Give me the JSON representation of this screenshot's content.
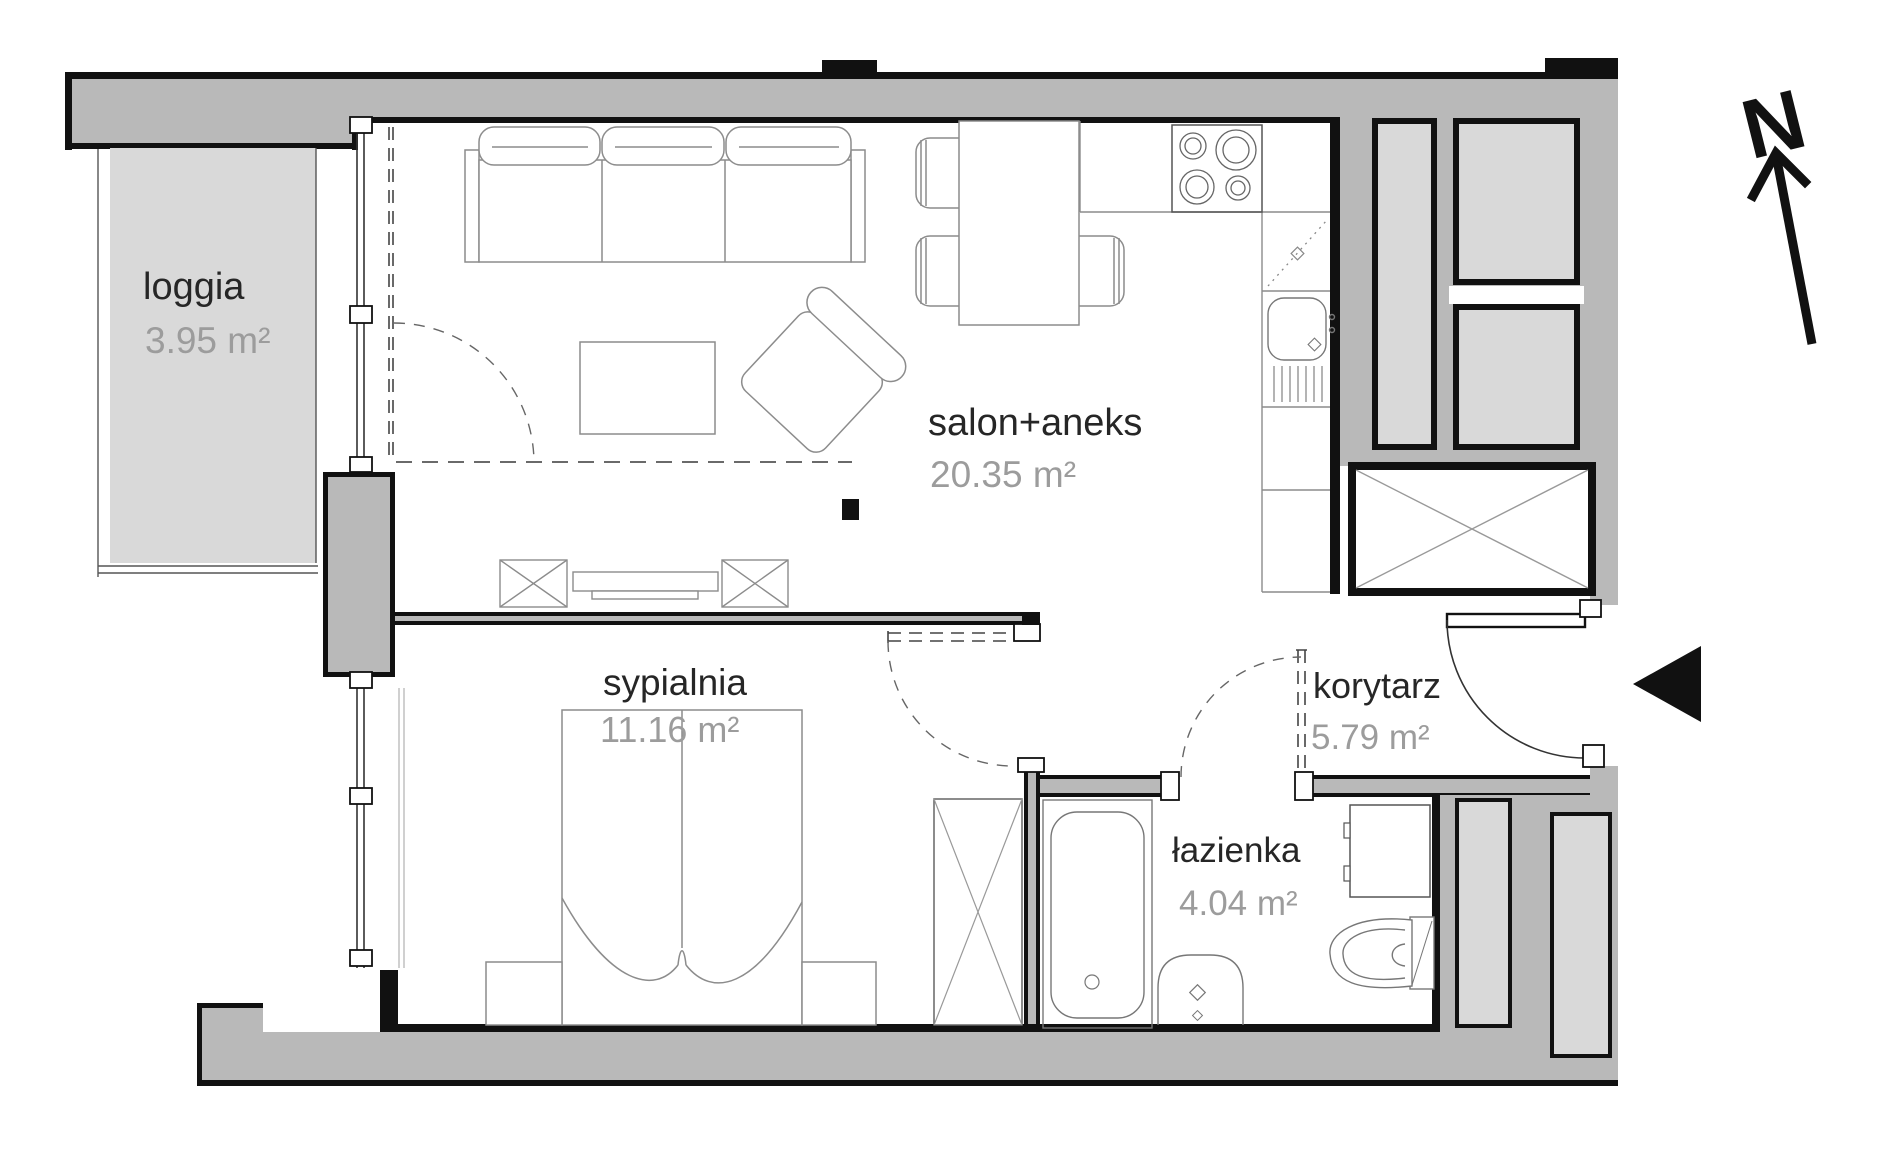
{
  "title": "Apartment floor plan",
  "compass": {
    "north_label": "N"
  },
  "rooms": [
    {
      "id": "loggia",
      "name": "loggia",
      "area": "3.95 m²"
    },
    {
      "id": "salon",
      "name": "salon+aneks",
      "area": "20.35 m²"
    },
    {
      "id": "sypialnia",
      "name": "sypialnia",
      "area": "11.16 m²"
    },
    {
      "id": "korytarz",
      "name": "korytarz",
      "area": "5.79 m²"
    },
    {
      "id": "lazienka",
      "name": "łazienka",
      "area": "4.04 m²"
    }
  ],
  "icons": [
    "north-arrow-icon",
    "entrance-arrow-icon"
  ],
  "colors": {
    "wall": "#111111",
    "building_mass": "#b9b9b9",
    "room_fill": "#d9d9d9",
    "label_text": "#262626",
    "area_text": "#9c9c9c",
    "furniture_line": "#8c8c8c"
  }
}
